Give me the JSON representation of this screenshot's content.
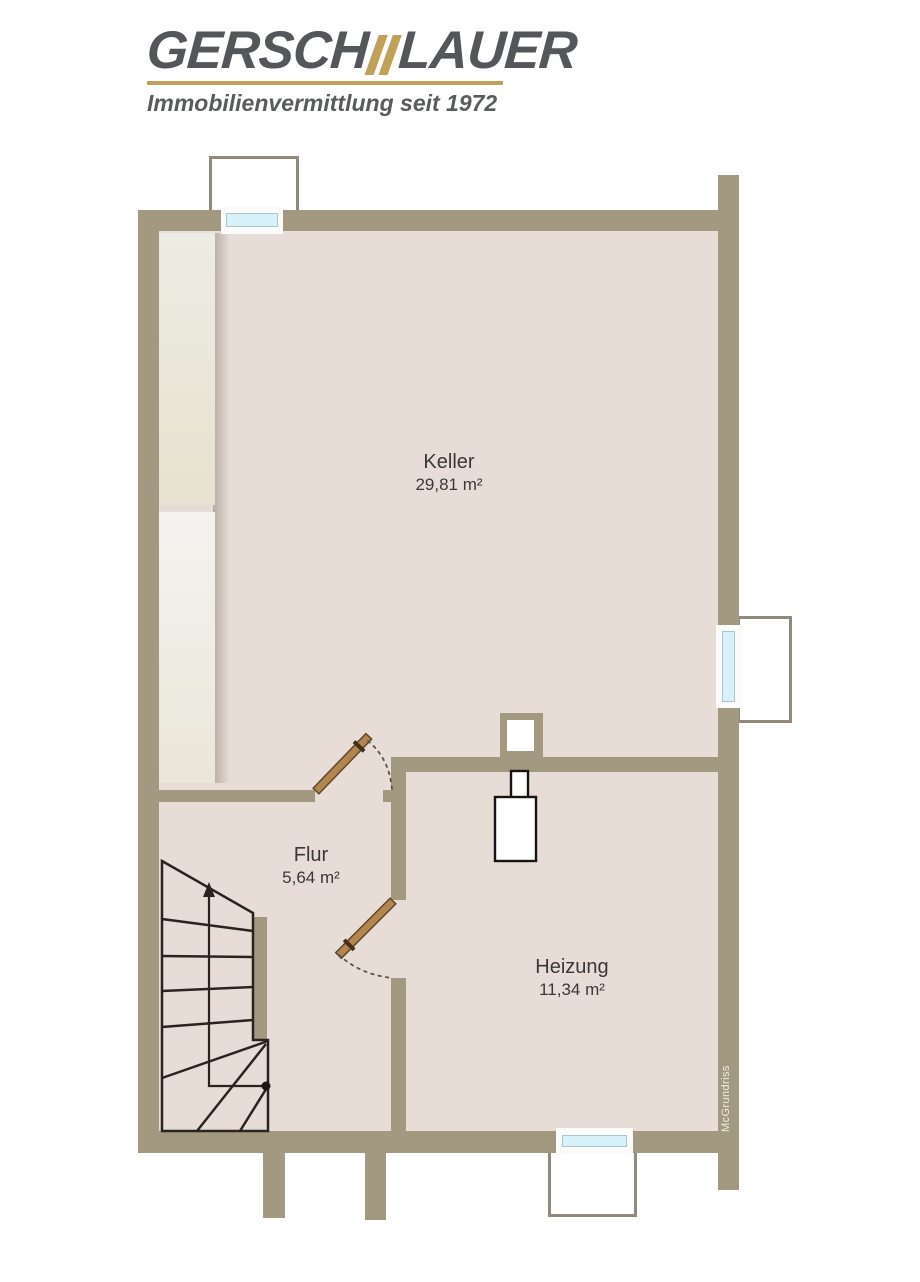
{
  "header": {
    "brand_left": "GERSCH",
    "brand_right": "LAUER",
    "accent_icon": "gold-double-slash",
    "tagline": "Immobilienvermittlung seit 1972",
    "colors": {
      "brand_text": "#55565a",
      "gold": "#c1a057"
    }
  },
  "floorplan": {
    "rooms": [
      {
        "name": "Keller",
        "area": "29,81 m²"
      },
      {
        "name": "Flur",
        "area": "5,64 m²"
      },
      {
        "name": "Heizung",
        "area": "11,34 m²"
      }
    ],
    "watermark": "McGrundriss",
    "colors": {
      "wall": "#a39981",
      "floor": "#e8ddd6",
      "glass": "#d7f1f8"
    }
  }
}
